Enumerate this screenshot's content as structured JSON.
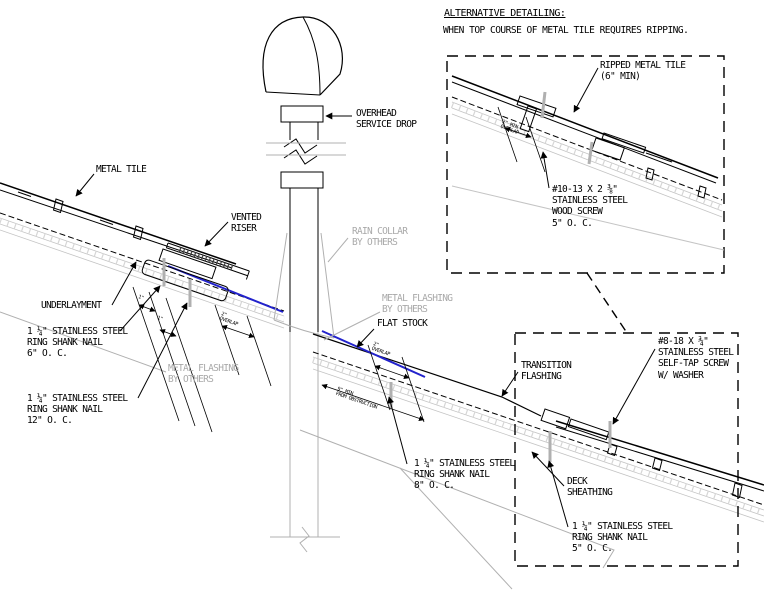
{
  "alt_detail": {
    "title": "ALTERNATIVE DETAILING:",
    "subtitle": "WHEN TOP COURSE OF METAL TILE REQUIRES RIPPING.",
    "ripped_tile": "RIPPED METAL TILE\n(6\" MIN)",
    "wood_screw": "#10-13 X 2 ⅜\"\nSTAINLESS STEEL\nWOOD SCREW\n5\" O. C.",
    "overlap_dim": "2\" MIN\nOVERLAP"
  },
  "main_detail": {
    "metal_tile": "METAL TILE",
    "vented_riser": "VENTED\nRISER",
    "underlayment": "UNDERLAYMENT",
    "nail_6oc": "1 ¼\" STAINLESS STEEL\nRING SHANK NAIL\n6\" O. C.",
    "metal_flashing_left": "METAL FLASHING\nBY OTHERS",
    "nail_12oc": "1 ¼\" STAINLESS STEEL\nRING SHANK NAIL\n12\" O. C.",
    "overhead_service_drop": "OVERHEAD\nSERVICE DROP",
    "rain_collar": "RAIN COLLAR\nBY OTHERS",
    "metal_flashing_center": "METAL FLASHING\nBY OTHERS",
    "flat_stock": "FLAT STOCK",
    "transition_flashing": "TRANSITION\nFLASHING",
    "self_tap_screw": "#8-18 X ¾\"\nSTAINLESS STEEL\nSELF-TAP SCREW\nW/ WASHER",
    "nail_8oc": "1 ¼\" STAINLESS STEEL\nRING SHANK NAIL\n8\" O. C.",
    "deck_sheathing": "DECK\nSHEATHING",
    "nail_5oc": "1 ¼\" STAINLESS STEEL\nRING SHANK NAIL\n5\" O. C.",
    "dim_overlap_left": "2\"\nOVERLAP",
    "dim_overlap_center": "2\"\nOVERLAP",
    "dim_one_a": "1\"",
    "dim_one_b": "1\"",
    "dim_obstruction": "9\" MIN\nFROM OBSTRUCTION"
  },
  "colors": {
    "line": "#000000",
    "gray": "#b0b0b0",
    "gray_text": "#a9a9a9",
    "highlight_blue": "#2222cc"
  }
}
